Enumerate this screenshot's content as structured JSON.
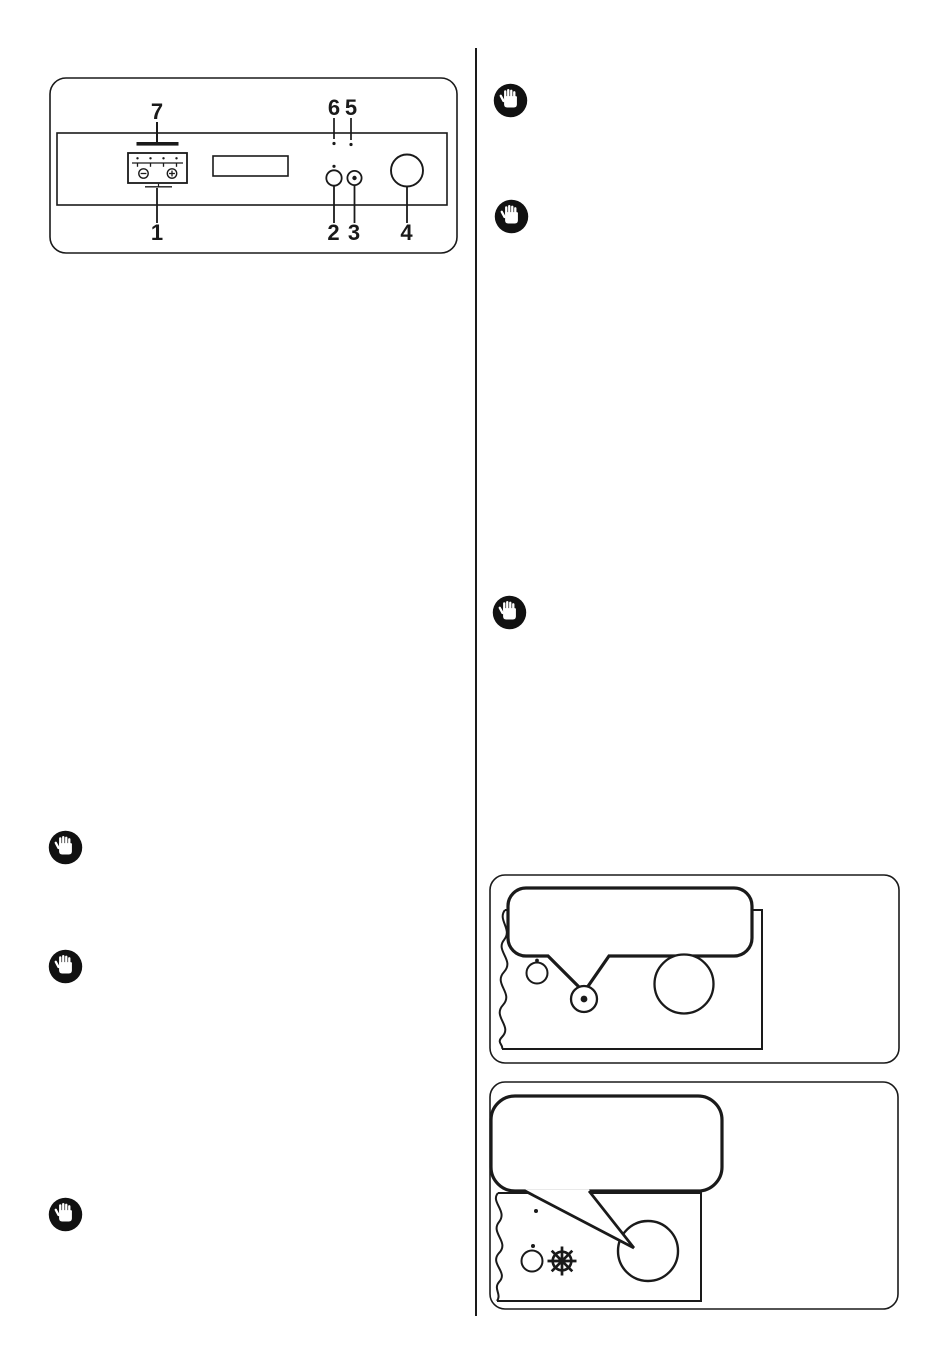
{
  "page": {
    "background": "#ffffff",
    "ink": "#1a1a1a"
  },
  "control_panel_figure": {
    "callouts": {
      "c1": "1",
      "c2": "2",
      "c3": "3",
      "c4": "4",
      "c5": "5",
      "c6": "6",
      "c7": "7"
    },
    "icons": {
      "minus_button": "minus-in-circle",
      "plus_button": "plus-in-circle"
    }
  },
  "notice_icon": {
    "name": "raised-hand-important-icon",
    "circle_color": "#111111",
    "hand_color": "#ffffff",
    "count": 6
  },
  "callout_box_1": {
    "balloon": "empty-speech-balloon",
    "points_to": "start-button-with-dot"
  },
  "callout_box_2": {
    "balloon": "empty-speech-balloon",
    "points_to": "program-knob",
    "symbol": "cold-wash-wheel-icon"
  }
}
